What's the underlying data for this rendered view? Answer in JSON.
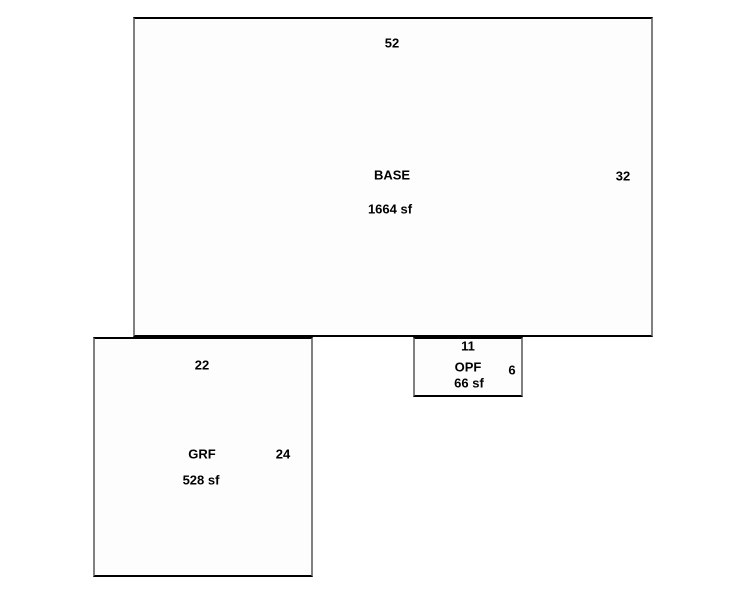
{
  "sketch": {
    "scale": "10 px per foot",
    "colors": {
      "background": "#ffffff",
      "fill": "#fdfdfd",
      "border_horizontal": "#000000",
      "border_vertical": "#808080",
      "text": "#000000"
    },
    "areas": {
      "base": {
        "name": "BASE",
        "sqft": "1664 sf",
        "top_dim": "52",
        "right_dim": "32"
      },
      "grf": {
        "name": "GRF",
        "sqft": "528 sf",
        "top_dim": "22",
        "right_dim": "24"
      },
      "opf": {
        "name": "OPF",
        "sqft": "66 sf",
        "top_dim": "11",
        "right_dim": "6"
      }
    }
  }
}
